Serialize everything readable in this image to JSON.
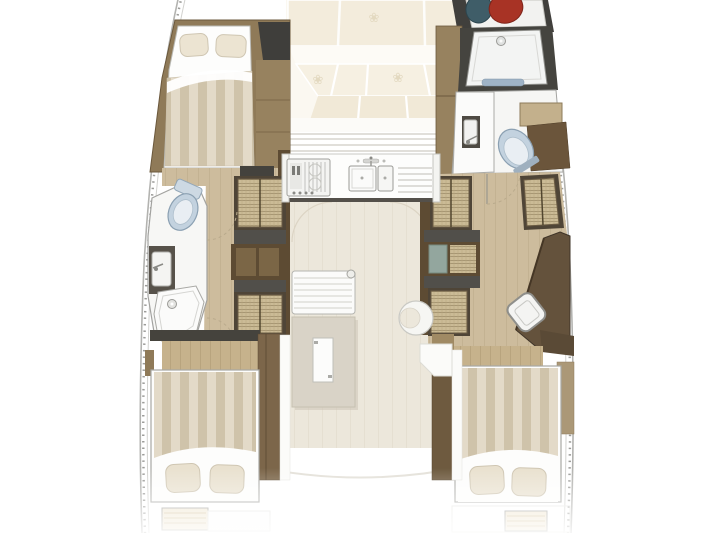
{
  "page": {
    "title_visible_text": "",
    "background": "#ffffff"
  },
  "diagram": {
    "type": "floor-plan",
    "subject": "sailing-catamaran-interior-top-view",
    "orientation": "bow-up",
    "text_labels": [],
    "motifs": {
      "flower_glyph": "❀"
    },
    "port_hull": {
      "forward_cabin": {
        "fixtures": [
          "double-bed",
          "two-pillows",
          "striped-duvet",
          "wardrobe-cabinet"
        ]
      },
      "mid_head": {
        "fixtures": [
          "toilet",
          "sink-vanity",
          "shower-tray-with-drain",
          "door-swing-arcs"
        ]
      },
      "companionway": {
        "fixtures": [
          "upper-wicker-steps",
          "storage-cabinet",
          "lower-wicker-steps",
          "wood-floor"
        ]
      },
      "aft_cabin": {
        "fixtures": [
          "double-bed",
          "two-pillows",
          "striped-duvet",
          "wardrobe-board",
          "wood-floor"
        ]
      },
      "transom": {
        "fixtures": [
          "swim-steps"
        ]
      }
    },
    "starboard_hull": {
      "bow_locker": {
        "fixtures": [
          "teal-gear-bag",
          "red-gear-bag",
          "white-tray"
        ]
      },
      "forward_head": {
        "fixtures": [
          "shower-tray-with-drain",
          "blue-bath-mat",
          "vanity-sink",
          "toilet",
          "wood-shelf",
          "dark-cabinet"
        ]
      },
      "companionway": {
        "fixtures": [
          "left-wicker-steps",
          "storage-cabinet-teal-panel",
          "lower-wicker-steps",
          "right-wicker-steps",
          "wood-floor",
          "door-swing-arc"
        ]
      },
      "nav_area": {
        "fixtures": [
          "chart-desk",
          "white-chair"
        ]
      },
      "aft_cabin": {
        "fixtures": [
          "double-bed",
          "two-pillows",
          "striped-duvet",
          "wardrobe-board",
          "wood-floor"
        ]
      },
      "transom": {
        "fixtures": [
          "swim-steps"
        ]
      }
    },
    "bridge_deck": {
      "bow_lounge": {
        "fixtures": [
          "cream-lounge-cushions",
          "flower-motifs"
        ]
      },
      "windshield": {
        "fixtures": [
          "window-mullion-lines"
        ]
      },
      "galley": {
        "fixtures": [
          "cooktop",
          "double-sink",
          "faucet",
          "drainboard"
        ]
      },
      "salon": {
        "fixtures": [
          "slatted-sofa",
          "folding-table-with-leaf",
          "crescent-seat",
          "light-wood-floor",
          "door-swing-arcs"
        ]
      },
      "aft_cockpit": {
        "fixtures": [
          "deck-edge-curve",
          "faint-step-boxes"
        ]
      }
    },
    "colors": {
      "wood_dark": "#6e5a3f",
      "wood_medium": "#8f7a58",
      "wood_light_floor": "#cdbc9d",
      "salon_floor": "#ece7db",
      "duvet_stripe_a": "#e3dac8",
      "duvet_stripe_b": "#cfc3aa",
      "cushion_cream": "#f2ecdd",
      "dark_gray": "#464646",
      "toilet_blue": "#c3d2df",
      "gear_red": "#a83325",
      "gear_teal": "#3f5d68",
      "hull_line": "#b3b3b0",
      "wicker": "#cbbb96"
    }
  }
}
